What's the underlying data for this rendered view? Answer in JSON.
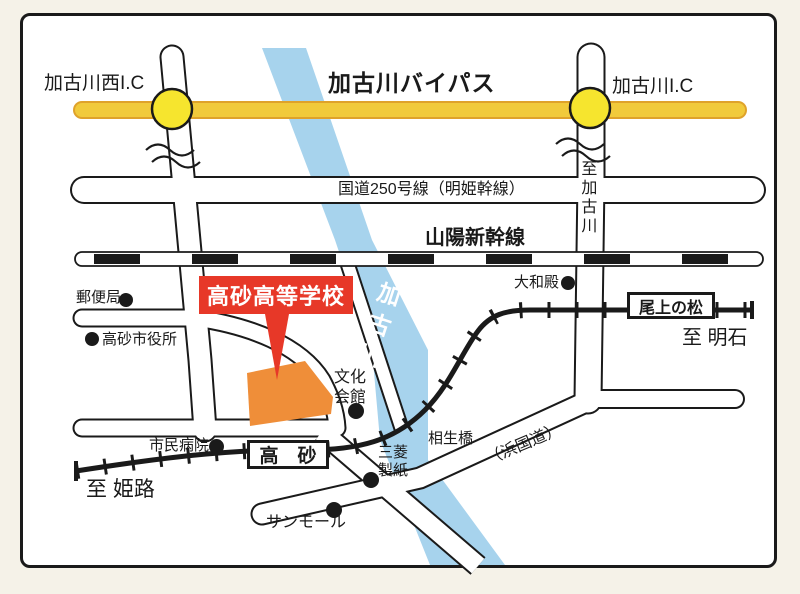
{
  "labels": {
    "bypass": "加古川バイパス",
    "ic_west": "加古川西I.C",
    "ic_east": "加古川I.C",
    "route250": "国道250号線（明姫幹線）",
    "shinkansen": "山陽新幹線",
    "to_kakogawa": "至加古川",
    "to_himeji": "至 姫路",
    "to_akashi": "至 明石",
    "school_banner": "高砂高等学校",
    "river": "加古川",
    "hama_kokudo": "（浜国道）",
    "aioi_bridge": "相生橋",
    "station_takasago": "高　砂",
    "station_onoe": "尾上の松"
  },
  "pois": [
    {
      "name": "郵便局"
    },
    {
      "name": "高砂市役所"
    },
    {
      "name": "大和殿"
    },
    {
      "name": "文化会館"
    },
    {
      "name": "市民病院"
    },
    {
      "name": "三菱製紙"
    },
    {
      "name": "サンモール"
    }
  ],
  "colors": {
    "bypass_yellow": "#f1ca3b",
    "bypass_edge": "#dfa22a",
    "ic_yellow": "#f6e52e",
    "river_blue": "#a7d3ed",
    "school_orange": "#ef8e39",
    "banner_red": "#e73828",
    "line_black": "#1a1a1a"
  }
}
